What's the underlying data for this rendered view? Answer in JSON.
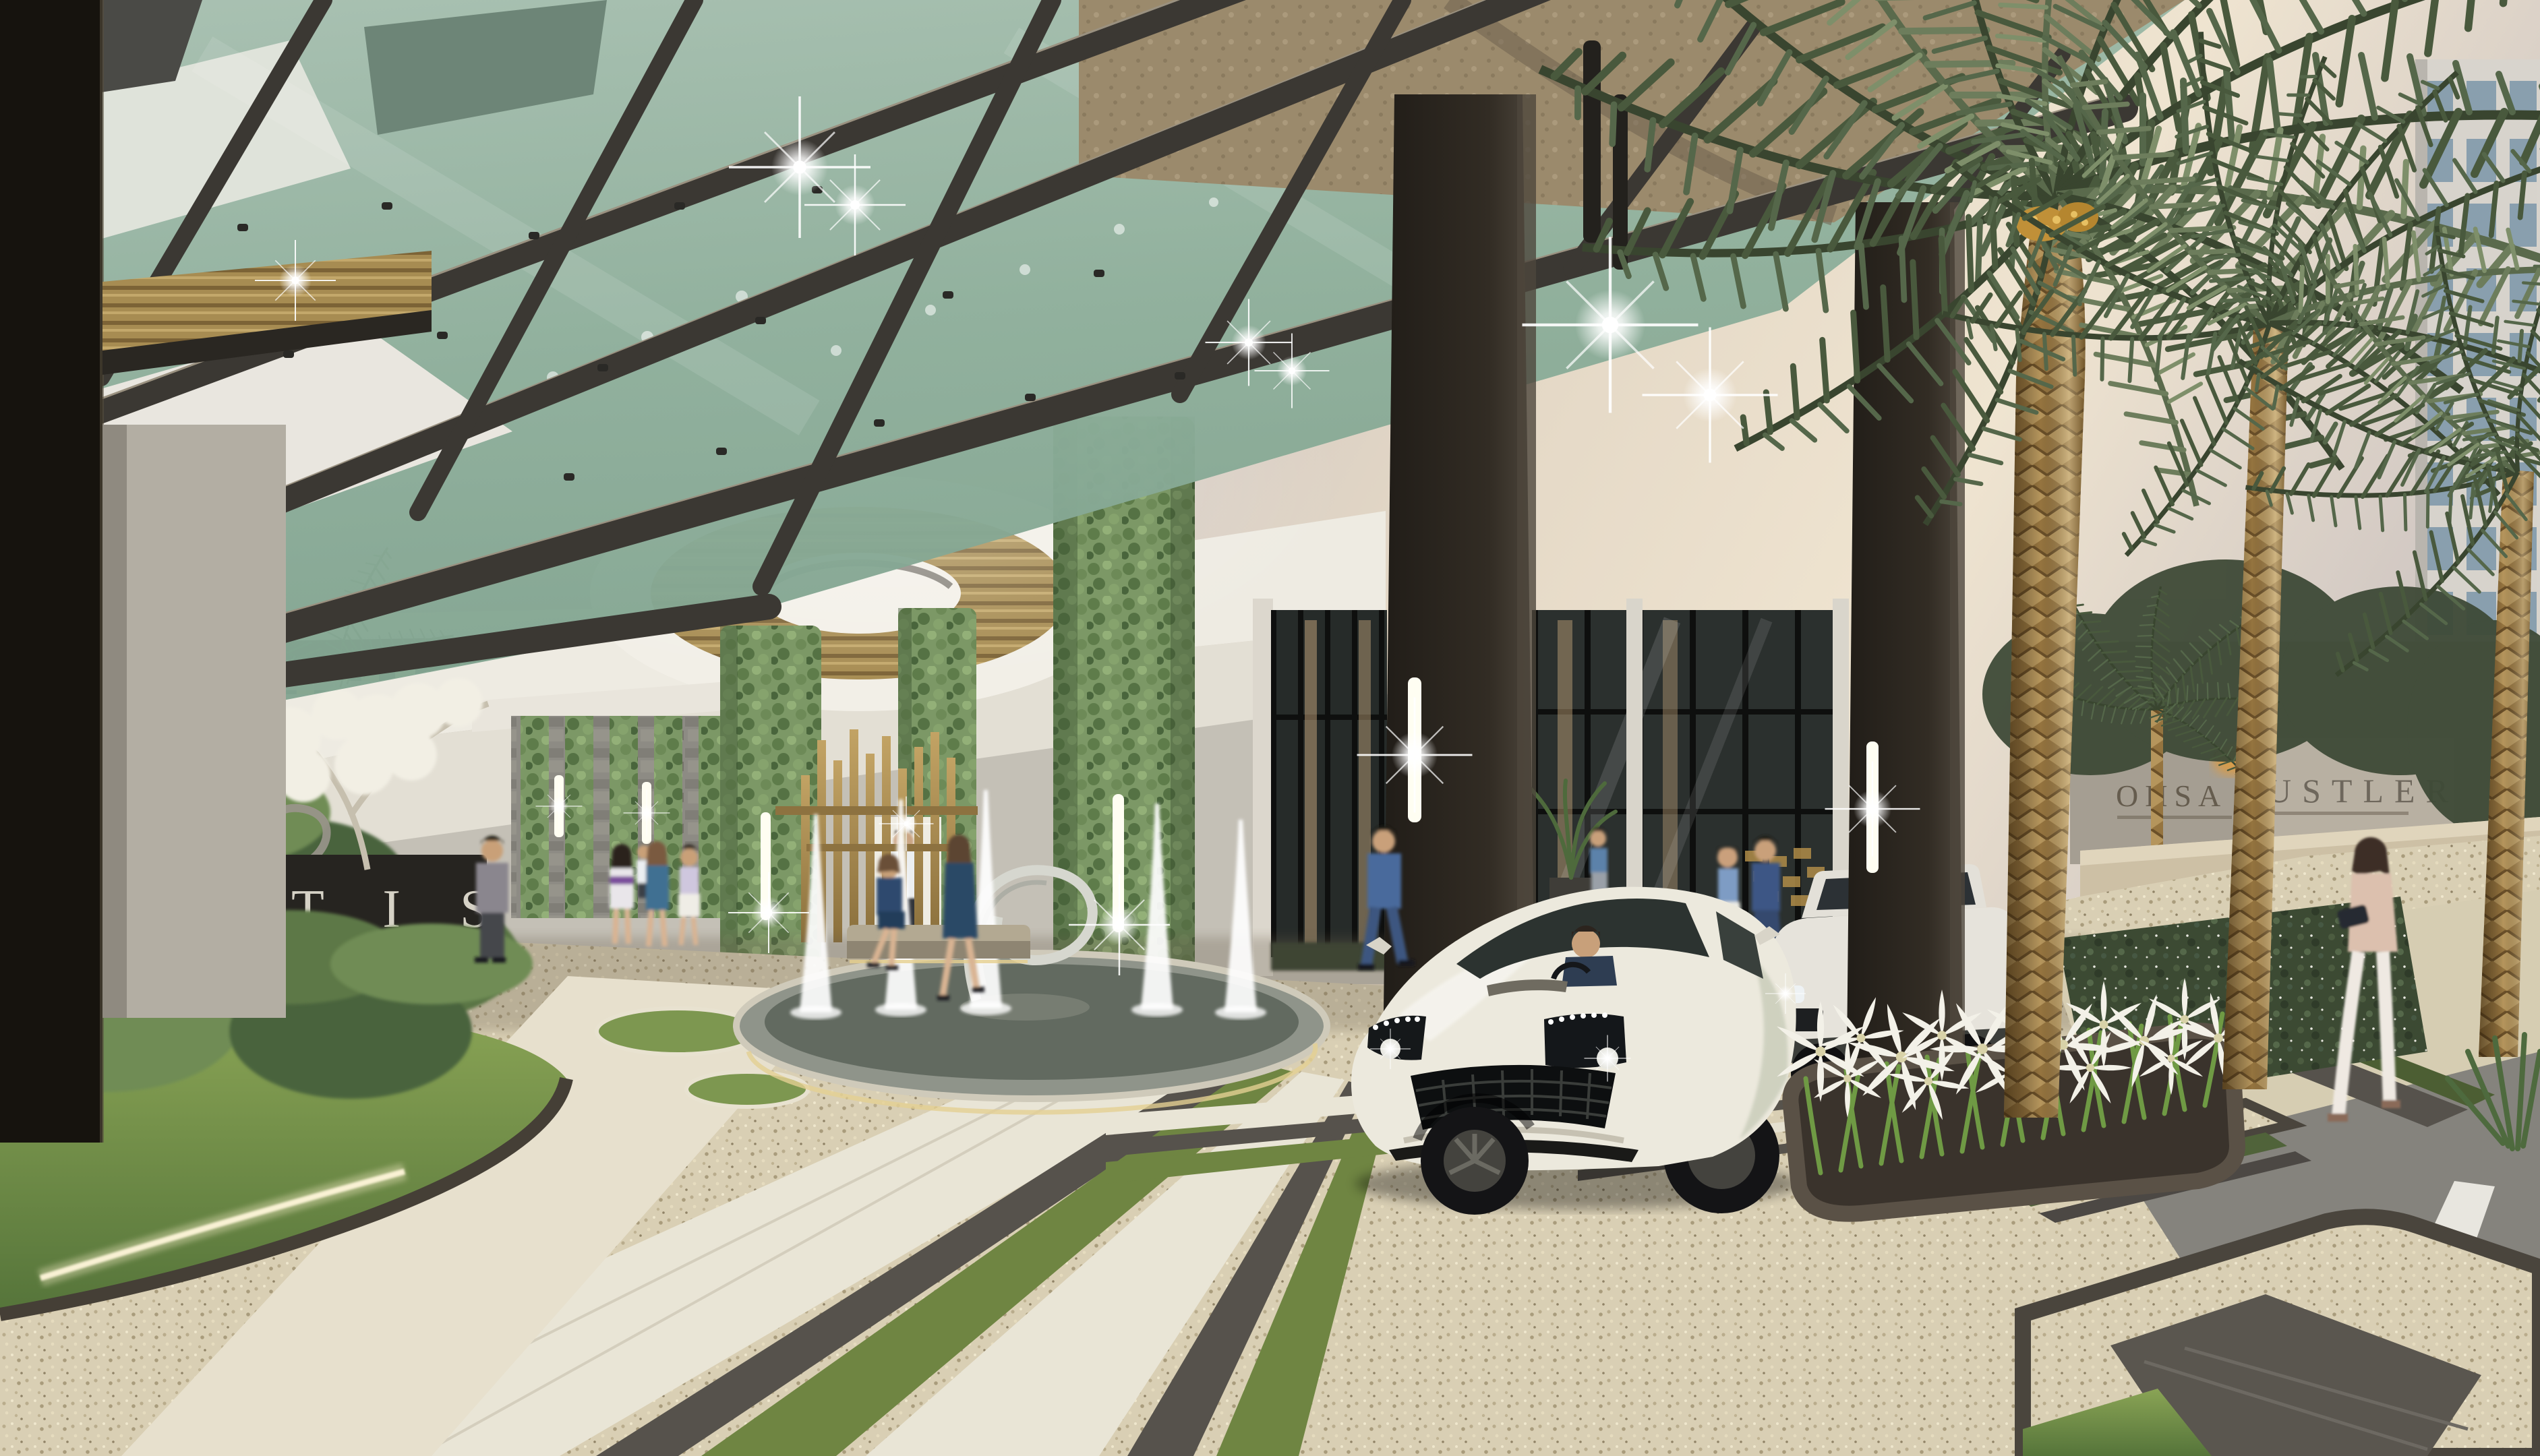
{
  "scene": {
    "type": "architectural-rendering",
    "setting": "Luxury residence entrance driveway at dusk with glass canopy porte-cochere, date palms, fountain garden and arriving sports car",
    "elements": [
      "glass-canopy",
      "vertical-garden-columns",
      "fountain",
      "date-palms",
      "white-sports-car",
      "white-suv",
      "spider-lily-planter",
      "city-street",
      "residents"
    ]
  },
  "signs": {
    "project_monolith_text": "T I S",
    "street_building_sign_left": "OHSA",
    "street_building_sign_right": "USTLER",
    "street_building_sign_partial": "CE"
  },
  "palette": {
    "sky_dusk_lavender": "#b3aeb8",
    "sky_dusk_cream": "#efe4d0",
    "canopy_glass_green": "#8fb09c",
    "beam_dark_bronze": "#3b3833",
    "ceiling_white": "#efece4",
    "gold_accent": "#a78c52",
    "leaf_green": "#7c9866",
    "lawn_green": "#7f9a4e",
    "gravel_beige": "#d9cfb4",
    "tile_white": "#e9e5d6",
    "stripe_charcoal": "#56524c",
    "pillar_bronze": "#2b2824",
    "palm_trunk_tan": "#95743f",
    "frond_olive": "#49593d",
    "car_pearl_white": "#ece9dd",
    "street_asphalt": "#85837d",
    "wall_beige": "#cdc0a5",
    "light_warm_white": "#fff6e2"
  }
}
